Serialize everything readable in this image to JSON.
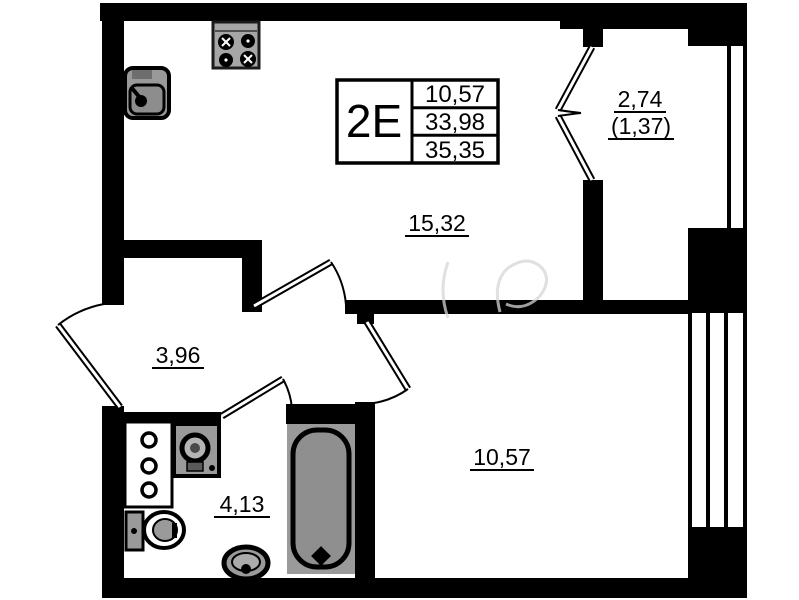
{
  "plan": {
    "unit": {
      "type_label": "2E",
      "values": [
        "10,57",
        "33,98",
        "35,35"
      ]
    },
    "rooms": {
      "living": {
        "area": "15,32"
      },
      "hall": {
        "area": "3,96"
      },
      "bathroom": {
        "area": "4,13"
      },
      "bedroom": {
        "area": "10,57"
      },
      "balcony": {
        "area": "2,74",
        "area_secondary": "(1,37)"
      }
    },
    "colors": {
      "walls": "#000000",
      "fixtures": "#9a9a9a",
      "background": "#ffffff"
    }
  }
}
